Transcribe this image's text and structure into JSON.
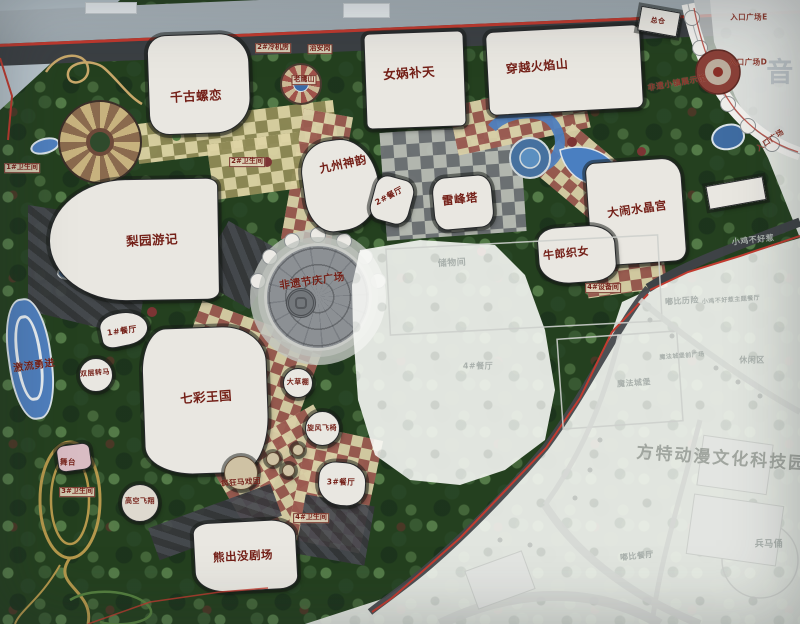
{
  "map": {
    "kind": "theme-park master plan photo",
    "colors": {
      "label": "#731f17",
      "faded_label": "#a9b0ac",
      "water": "#4f7fbe",
      "road_red": "#c0392e",
      "paving_red": "#9b5a50",
      "paving_tan": "#ddd3a4"
    },
    "watermark_text": "方特动漫文化科技园",
    "labels_park": [
      {
        "name": "label-qiangu-luolian",
        "text": "千古螺恋",
        "x": 196,
        "y": 95,
        "r": -3,
        "cls": "major"
      },
      {
        "name": "label-nvwa-butian",
        "text": "女娲补天",
        "x": 409,
        "y": 72,
        "r": -4,
        "cls": "major"
      },
      {
        "name": "label-chuanyue-huoyanshan",
        "text": "穿越火焰山",
        "x": 537,
        "y": 66,
        "r": -5,
        "cls": "major",
        "fs": 12
      },
      {
        "name": "label-jiuzhou-shenyun",
        "text": "九州神韵",
        "x": 343,
        "y": 164,
        "r": -12,
        "cls": "major",
        "fs": 11.5
      },
      {
        "name": "label-liyuan-youji",
        "text": "梨园游记",
        "x": 152,
        "y": 239,
        "r": -3,
        "cls": "major"
      },
      {
        "name": "label-leifengta",
        "text": "雷峰塔",
        "x": 460,
        "y": 199,
        "r": -6,
        "cls": "major",
        "fs": 11.5
      },
      {
        "name": "label-danao-shuijinggong",
        "text": "大闹水晶宫",
        "x": 637,
        "y": 209,
        "r": -8,
        "cls": "major",
        "fs": 11.5
      },
      {
        "name": "label-niulang-zhinv",
        "text": "牛郎织女",
        "x": 566,
        "y": 253,
        "r": -6,
        "cls": "major",
        "fs": 11
      },
      {
        "name": "label-qicai-wangguo",
        "text": "七彩王国",
        "x": 206,
        "y": 396,
        "r": -4,
        "cls": "major"
      },
      {
        "name": "label-xiongchumo-juchang",
        "text": "熊出没剧场",
        "x": 243,
        "y": 556,
        "r": -3,
        "cls": "major",
        "fs": 11.5
      },
      {
        "name": "label-feiyi-jieqing-plaza",
        "text": "非遗节庆广场",
        "x": 312,
        "y": 281,
        "r": -8,
        "cls": "major",
        "fs": 10.5
      },
      {
        "name": "label-jiliu-yongjin",
        "text": "激流勇进",
        "x": 34,
        "y": 364,
        "r": -8,
        "cls": "major",
        "fs": 10
      },
      {
        "name": "label-restaurant-2",
        "text": "2#餐厅",
        "x": 389,
        "y": 196,
        "r": -28,
        "cls": "mid"
      },
      {
        "name": "label-restaurant-1",
        "text": "1#餐厅",
        "x": 122,
        "y": 331,
        "r": -8,
        "cls": "mid"
      },
      {
        "name": "label-restaurant-3",
        "text": "3#餐厅",
        "x": 341,
        "y": 482,
        "r": 0,
        "cls": "mid",
        "fs": 7.5
      },
      {
        "name": "label-shuangceng-zhuanma",
        "text": "双层转马",
        "x": 95,
        "y": 373,
        "r": -5,
        "cls": "mid",
        "fs": 7
      },
      {
        "name": "label-wutai",
        "text": "舞台",
        "x": 68,
        "y": 462,
        "r": 0,
        "cls": "mid",
        "fs": 7.5
      },
      {
        "name": "label-gaokong-feixiang",
        "text": "高空飞翔",
        "x": 140,
        "y": 501,
        "r": 0,
        "cls": "mid",
        "fs": 7
      },
      {
        "name": "label-fengkuang-maxituan",
        "text": "疯狂马戏团",
        "x": 241,
        "y": 482,
        "r": -4,
        "cls": "mid",
        "fs": 7.5
      },
      {
        "name": "label-dacaopeng",
        "text": "大草棚",
        "x": 298,
        "y": 382,
        "r": 0,
        "cls": "mid",
        "fs": 7
      },
      {
        "name": "label-xuanfeng-feiyi",
        "text": "旋风飞椅",
        "x": 322,
        "y": 428,
        "r": 0,
        "cls": "mid",
        "fs": 7
      },
      {
        "name": "label-zongcang",
        "text": "总仓",
        "x": 658,
        "y": 21,
        "r": 6,
        "cls": "mid",
        "fs": 7
      },
      {
        "name": "label-lengjifang",
        "text": "2#冷机房",
        "x": 273,
        "y": 48,
        "r": 0,
        "cls": "chip"
      },
      {
        "name": "label-zhiangang",
        "text": "治安岗",
        "x": 320,
        "y": 49,
        "r": 0,
        "cls": "chip"
      },
      {
        "name": "label-laoyingshan",
        "text": "老鹰山",
        "x": 304,
        "y": 80,
        "r": 0,
        "cls": "chip"
      },
      {
        "name": "label-weishengjian-1",
        "text": "1#卫生间",
        "x": 22,
        "y": 168,
        "r": 0,
        "cls": "chip"
      },
      {
        "name": "label-weishengjian-2",
        "text": "2#卫生间",
        "x": 247,
        "y": 162,
        "r": 0,
        "cls": "chip"
      },
      {
        "name": "label-weishengjian-3",
        "text": "3#卫生间",
        "x": 77,
        "y": 492,
        "r": 0,
        "cls": "chip"
      },
      {
        "name": "label-weishengjian-4",
        "text": "4#卫生间",
        "x": 311,
        "y": 518,
        "r": 0,
        "cls": "chip"
      },
      {
        "name": "label-shebeijian",
        "text": "4#设备间",
        "x": 603,
        "y": 288,
        "r": 0,
        "cls": "chip"
      }
    ],
    "labels_upper": [
      {
        "name": "label-entrance-plaza-e",
        "text": "入口广场E",
        "x": 749,
        "y": 17,
        "r": 0,
        "cls": "entr"
      },
      {
        "name": "label-entrance-plaza-d",
        "text": "入口广场D",
        "x": 748,
        "y": 62,
        "r": 0,
        "cls": "entr"
      },
      {
        "name": "label-entrance-plaza",
        "text": "入口广场",
        "x": 770,
        "y": 140,
        "r": -35,
        "cls": "entr"
      },
      {
        "name": "label-feiyi-town-hall",
        "text": "非遗小镇展示馆",
        "x": 677,
        "y": 83,
        "r": -10,
        "cls": "entr",
        "fs": 8
      },
      {
        "name": "label-chuwujian",
        "text": "储物间",
        "x": 452,
        "y": 262,
        "r": -3,
        "cls": "fade-l",
        "fs": 9
      },
      {
        "name": "label-restaurant-4",
        "text": "4#餐厅",
        "x": 478,
        "y": 366,
        "r": 0,
        "cls": "fade-l",
        "fs": 8
      },
      {
        "name": "label-xiaoji-buhaore",
        "text": "小鸡不好惹",
        "x": 753,
        "y": 240,
        "r": -6,
        "cls": "fade-l",
        "fs": 8
      },
      {
        "name": "label-dubi-lixian",
        "text": "嘟比历险",
        "x": 682,
        "y": 301,
        "r": -4,
        "cls": "fade-l",
        "fs": 8
      },
      {
        "name": "label-xiaoji-restaurant",
        "text": "小鸡不好惹主题餐厅",
        "x": 731,
        "y": 299,
        "r": -4,
        "cls": "fade-l",
        "fs": 6
      },
      {
        "name": "label-mofa-chengbao",
        "text": "魔法城堡",
        "x": 634,
        "y": 383,
        "r": -4,
        "cls": "fade-l",
        "fs": 8
      },
      {
        "name": "label-mofa-qianguangchang",
        "text": "魔法城堡前广场",
        "x": 682,
        "y": 355,
        "r": -4,
        "cls": "fade-l",
        "fs": 6
      },
      {
        "name": "label-xiuxianqu",
        "text": "休闲区",
        "x": 752,
        "y": 360,
        "r": 0,
        "cls": "fade-l",
        "fs": 8
      },
      {
        "name": "label-dubi-canting",
        "text": "嘟比餐厅",
        "x": 637,
        "y": 556,
        "r": -6,
        "cls": "fade-l",
        "fs": 8
      },
      {
        "name": "label-bingmayong",
        "text": "兵马俑",
        "x": 769,
        "y": 543,
        "r": 0,
        "cls": "fade-l",
        "fs": 9
      },
      {
        "name": "label-music-char",
        "text": "音",
        "x": 780,
        "y": 70,
        "r": 0,
        "cls": "music"
      },
      {
        "name": "label-watermark",
        "text": "方特动漫文化科技园",
        "x": 722,
        "y": 456,
        "r": 4,
        "cls": "wmark"
      }
    ]
  }
}
